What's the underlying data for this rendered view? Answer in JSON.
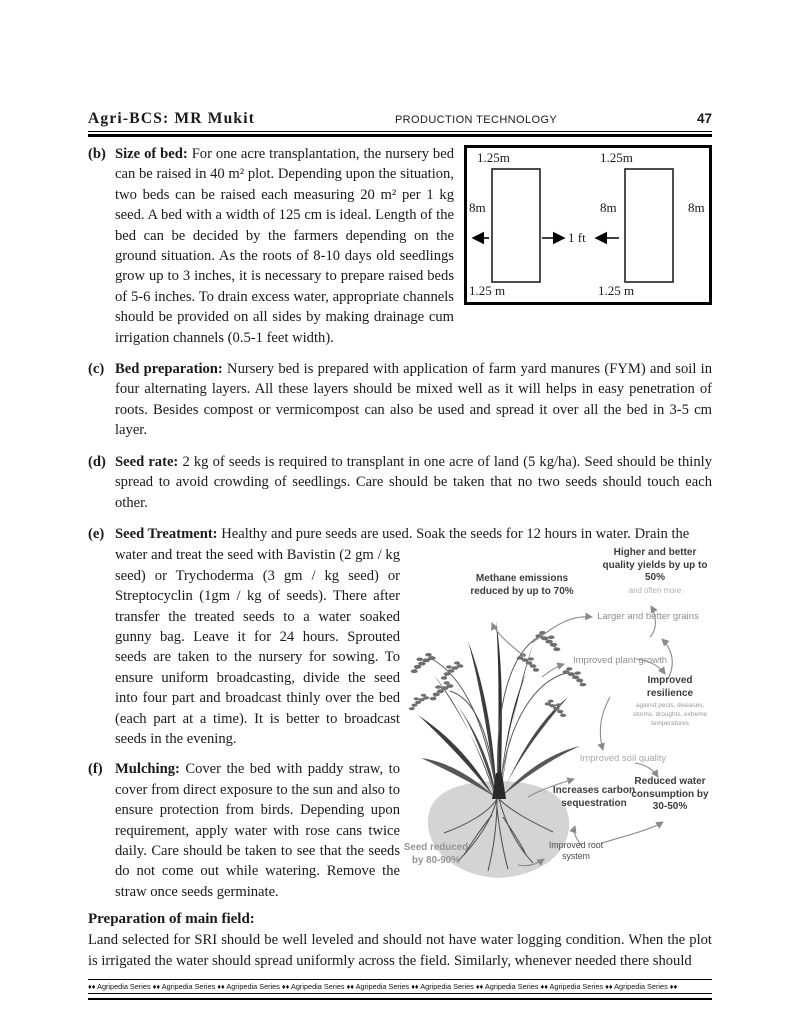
{
  "header": {
    "left": "Agri-BCS: MR Mukit",
    "center": "PRODUCTION TECHNOLOGY",
    "page_number": "47"
  },
  "sections": {
    "b": {
      "label": "(b)",
      "title": "Size of bed:",
      "text": "For one acre transplantation, the nursery bed can be raised in 40 m² plot. Depending upon the situation, two beds can be raised each measuring 20 m² per 1 kg seed. A bed with a width of 125 cm is ideal. Length of the bed can be decided by the farmers depending on the ground situation. As the roots of 8-10 days old seedlings grow up to 3 inches, it is necessary to prepare raised beds of 5-6 inches. To drain excess water, appropriate channels should be provided on all sides by making drainage cum irrigation channels (0.5-1 feet width)."
    },
    "c": {
      "label": "(c)",
      "title": "Bed preparation:",
      "text": "Nursery bed is prepared with application of farm yard manures (FYM) and soil in four alternating layers. All these layers should be mixed well as it will helps in easy penetration of roots. Besides compost or vermicompost can also be used and spread it over all the bed in 3-5 cm layer."
    },
    "d": {
      "label": "(d)",
      "title": "Seed rate:",
      "text": "2 kg of seeds is required to transplant in one acre of land (5 kg/ha). Seed should be thinly spread to avoid crowding of seedlings. Care should be taken that no two seeds should touch each other."
    },
    "e": {
      "label": "(e)",
      "title": "Seed Treatment:",
      "line1": "Healthy and pure seeds are used. Soak the seeds for 12 hours in water. Drain the",
      "text": "water and treat the seed with Bavistin (2 gm / kg seed) or Trychoderma (3 gm / kg seed) or Streptocyclin (1gm / kg of seeds). There after transfer the treated seeds to a water soaked gunny bag. Leave it for 24 hours. Sprouted seeds are taken to the nursery for sowing. To ensure uniform broadcasting, divide the seed into four part and broadcast thinly over the bed (each part at a time). It is better to broadcast seeds in the evening."
    },
    "f": {
      "label": "(f)",
      "title": "Mulching:",
      "text": "Cover the bed with paddy straw, to cover from direct exposure to the sun and also to ensure protection from birds. Depending upon requirement, apply water with rose cans twice daily. Care should be taken to see that the seeds do not come out while watering. Remove the straw once seeds germinate."
    }
  },
  "bed_diagram": {
    "top_left": "1.25m",
    "top_right": "1.25m",
    "side_left": "8m",
    "side_mid": "8m",
    "side_right": "8m",
    "gap": "1 ft",
    "bottom_left": "1.25 m",
    "bottom_right": "1.25 m"
  },
  "illustration": {
    "methane": "Methane emissions reduced by up to 70%",
    "higher_yields": "Higher and better quality yields by up to 50%",
    "higher_yields_sub": "and often more",
    "larger_grains": "Larger and better grains",
    "plant_growth": "Improved plant growth",
    "resilience": "Improved resilience",
    "resilience_sub": "against pests, diseases, storms, droughts, extreme temperatures",
    "soil_quality": "Improved soil quality",
    "carbon": "Increases carbon sequestration",
    "water": "Reduced water consumption by 30-50%",
    "root_system": "Improved root system",
    "seed_reduced": "Seed reduced by 80-90%"
  },
  "main_field": {
    "title": "Preparation of main field:",
    "text": "Land selected for SRI should be well leveled and should not have water logging condition. When the plot is irrigated the water should spread uniformly across the field. Similarly, whenever needed there should"
  },
  "footer": {
    "text": "♦♦  Agripedia Series  ♦♦  Agripedia Series  ♦♦  Agripedia Series  ♦♦  Agripedia Series  ♦♦  Agripedia Series  ♦♦  Agripedia Series  ♦♦  Agripedia Series  ♦♦  Agripedia Series  ♦♦  Agripedia Series  ♦♦"
  },
  "colors": {
    "text": "#1a1a1a",
    "label_dark": "#3d3d3d",
    "label_gray": "#8f8f8f",
    "arrow": "#8a8a8a"
  }
}
